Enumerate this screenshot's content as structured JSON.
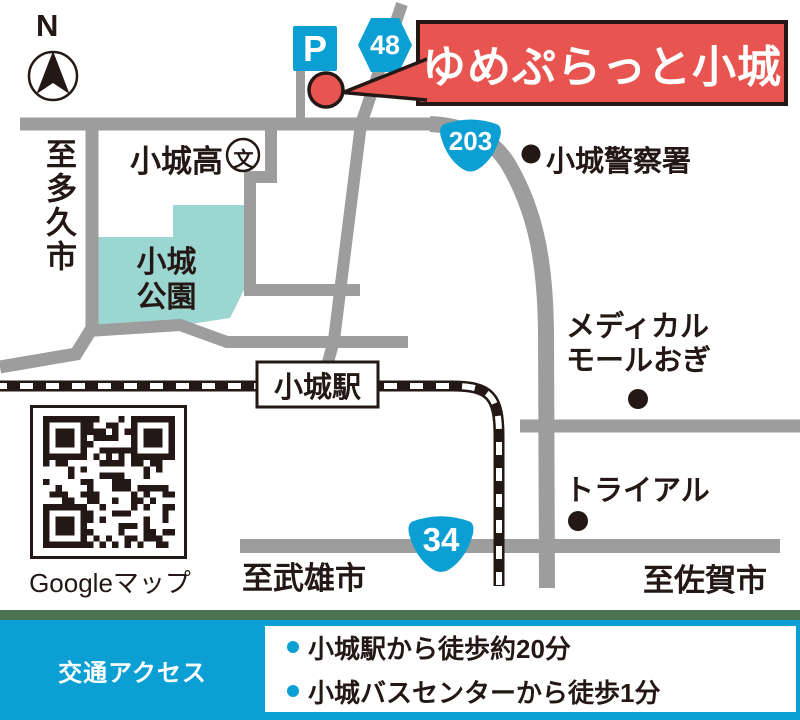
{
  "banner": {
    "title": "ゆめぷらっと小城"
  },
  "compass": {
    "label": "N"
  },
  "map": {
    "parking_label": "P",
    "routes": {
      "r48": "48",
      "r203": "203",
      "r34": "34"
    },
    "labels": {
      "to_taku": "至多久市",
      "high_school": "小城高",
      "school_symbol": "文",
      "park_line1": "小城",
      "park_line2": "公園",
      "police": "小城警察署",
      "station": "小城駅",
      "medical_line1": "メディカル",
      "medical_line2": "モールおぎ",
      "trial": "トライアル",
      "to_takeo": "至武雄市",
      "to_saga": "至佐賀市"
    },
    "qr_caption": "Googleマップ"
  },
  "footer": {
    "heading": "交通アクセス",
    "items": [
      "小城駅から徒歩約20分",
      "小城バスセンターから徒歩1分"
    ]
  },
  "colors": {
    "sign_blue": "#0c9fd4",
    "banner_red": "#e8544f",
    "park_teal": "#9cd6d0",
    "road_gray": "#9d9d9d",
    "divider_green": "#4d7153",
    "ink_black": "#231815"
  }
}
